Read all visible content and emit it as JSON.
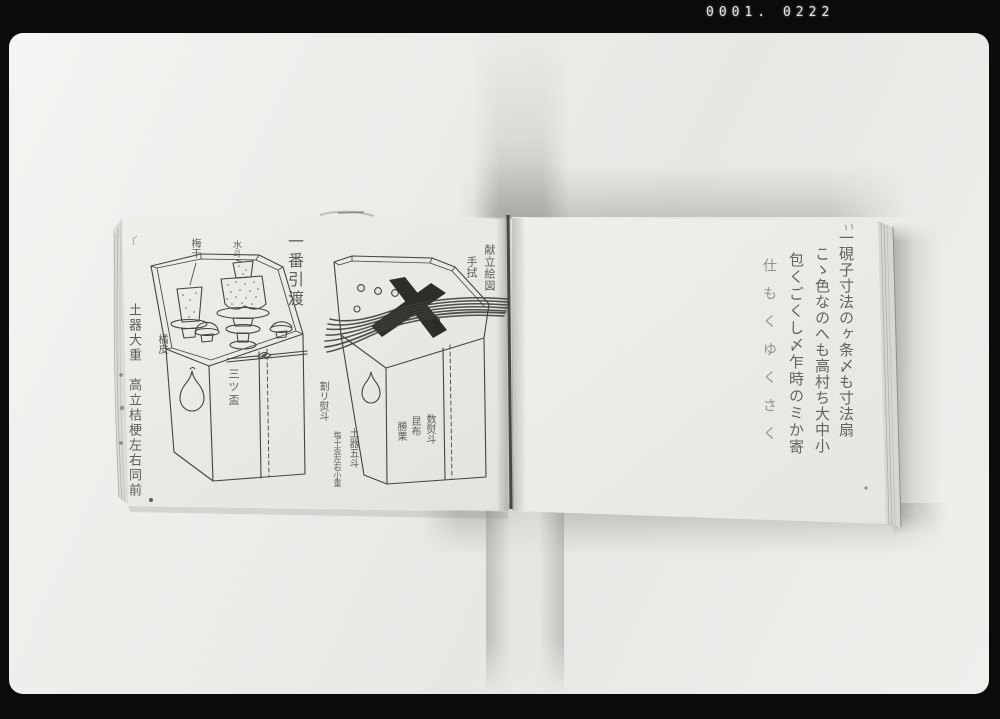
{
  "frame": {
    "counter": "0001. 0222"
  },
  "left_page": {
    "caption_ichiban": "一番引渡",
    "margin_note": "土器大重　高立桔梗左右同前",
    "box1_labels": {
      "umeboshi": "梅干",
      "mizunomi": "水斗",
      "kippi": "橘皮",
      "mitsusakazuki": "三ツ盃"
    },
    "box2_labels": {
      "kondate_ezu": "献立絵図",
      "tenugui": "手拭",
      "wari_noshi": "割リ熨斗",
      "doki_goto": "土器五斗",
      "shio_note": "塩十盃左右小重",
      "kazu_noshi": "数熨斗",
      "konbu": "昆布",
      "kachiguri": "勝栗"
    }
  },
  "right_page": {
    "columns": [
      "一硯子寸法のヶ条〆も寸法扇",
      "こゝ色なのへも高村ち大中小",
      "包くごくし〆乍時のミか寄",
      "仕もくゆくさく"
    ]
  }
}
